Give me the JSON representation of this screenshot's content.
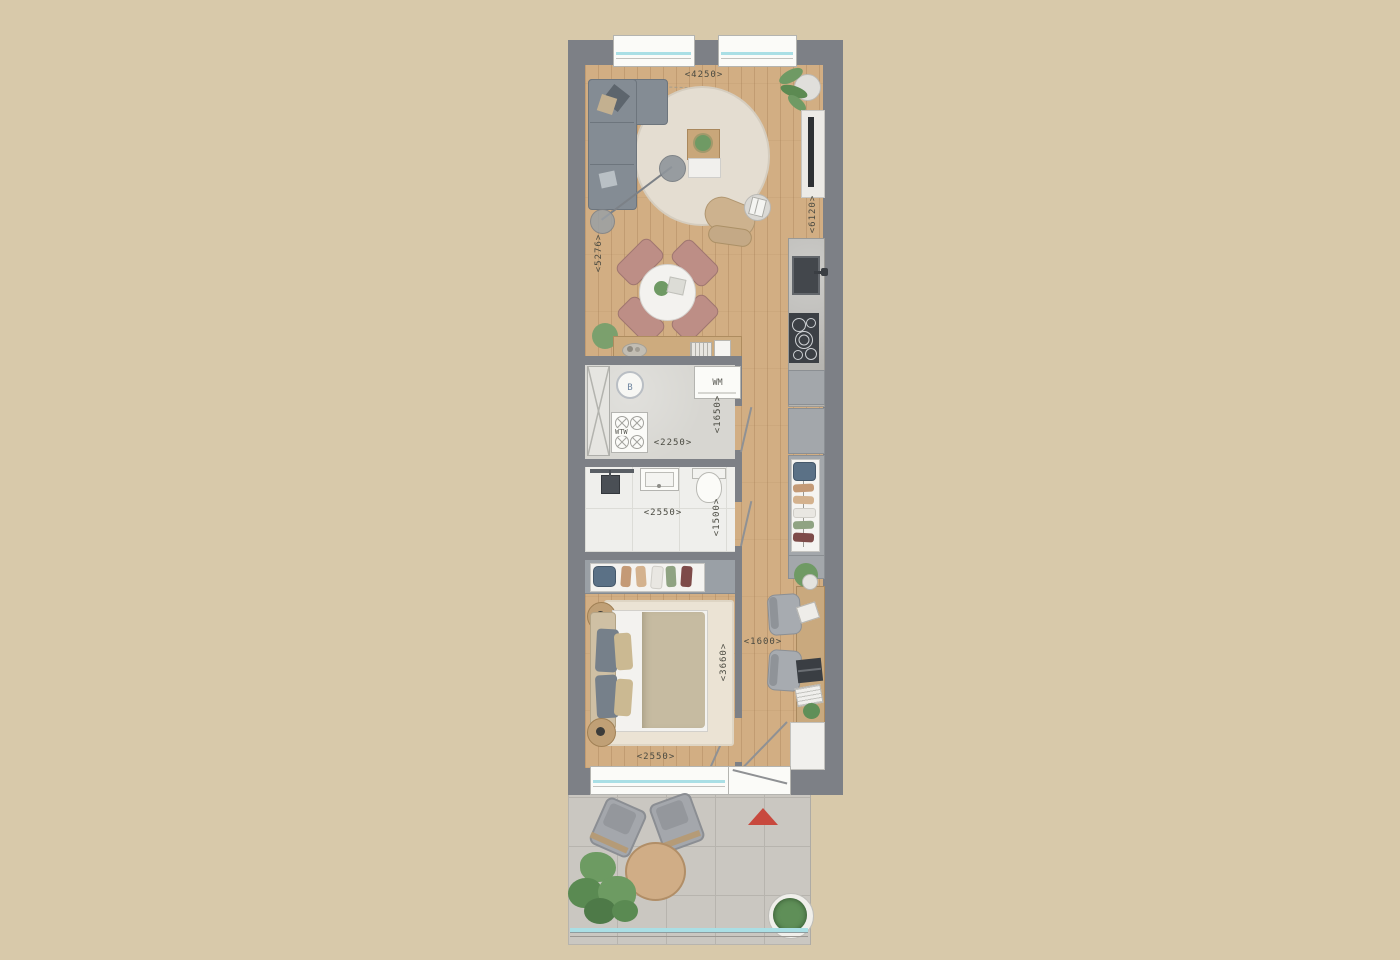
{
  "plan": {
    "type": "apartment-floor-plan-top-view",
    "dims": {
      "living_w": "<4250>",
      "living_h_left": "<5276>",
      "living_h_right": "<6120>",
      "utility_w": "<2250>",
      "utility_h": "<1650>",
      "bath_w": "<2550>",
      "bath_h": "<1500>",
      "bed_w": "<2550>",
      "bed_h": "<3660>",
      "hall_w": "<1600>"
    },
    "units": {
      "boiler": "B",
      "washing_machine": "WM",
      "heat_recovery": "WTW"
    },
    "colors": {
      "background": "#d8c9aa",
      "wall": "#7d8086",
      "wood_floor": "#d2ae83",
      "utility_floor": "#d7d6d1",
      "bathroom_floor": "#efefec",
      "terrace_tiles": "#cac7c1",
      "kitchen_counter": "#b6b5b1",
      "cabinet_gray": "#a3a7ab",
      "sofa_gray": "#848c94",
      "dining_chair_rose": "#bd8e86",
      "rug_cream": "#e4ddd1",
      "duvet_beige": "#c6bba1",
      "glass_blue": "#aadfe5",
      "north_arrow_red": "#c8493e",
      "plant_green": "#6f9a64"
    }
  }
}
